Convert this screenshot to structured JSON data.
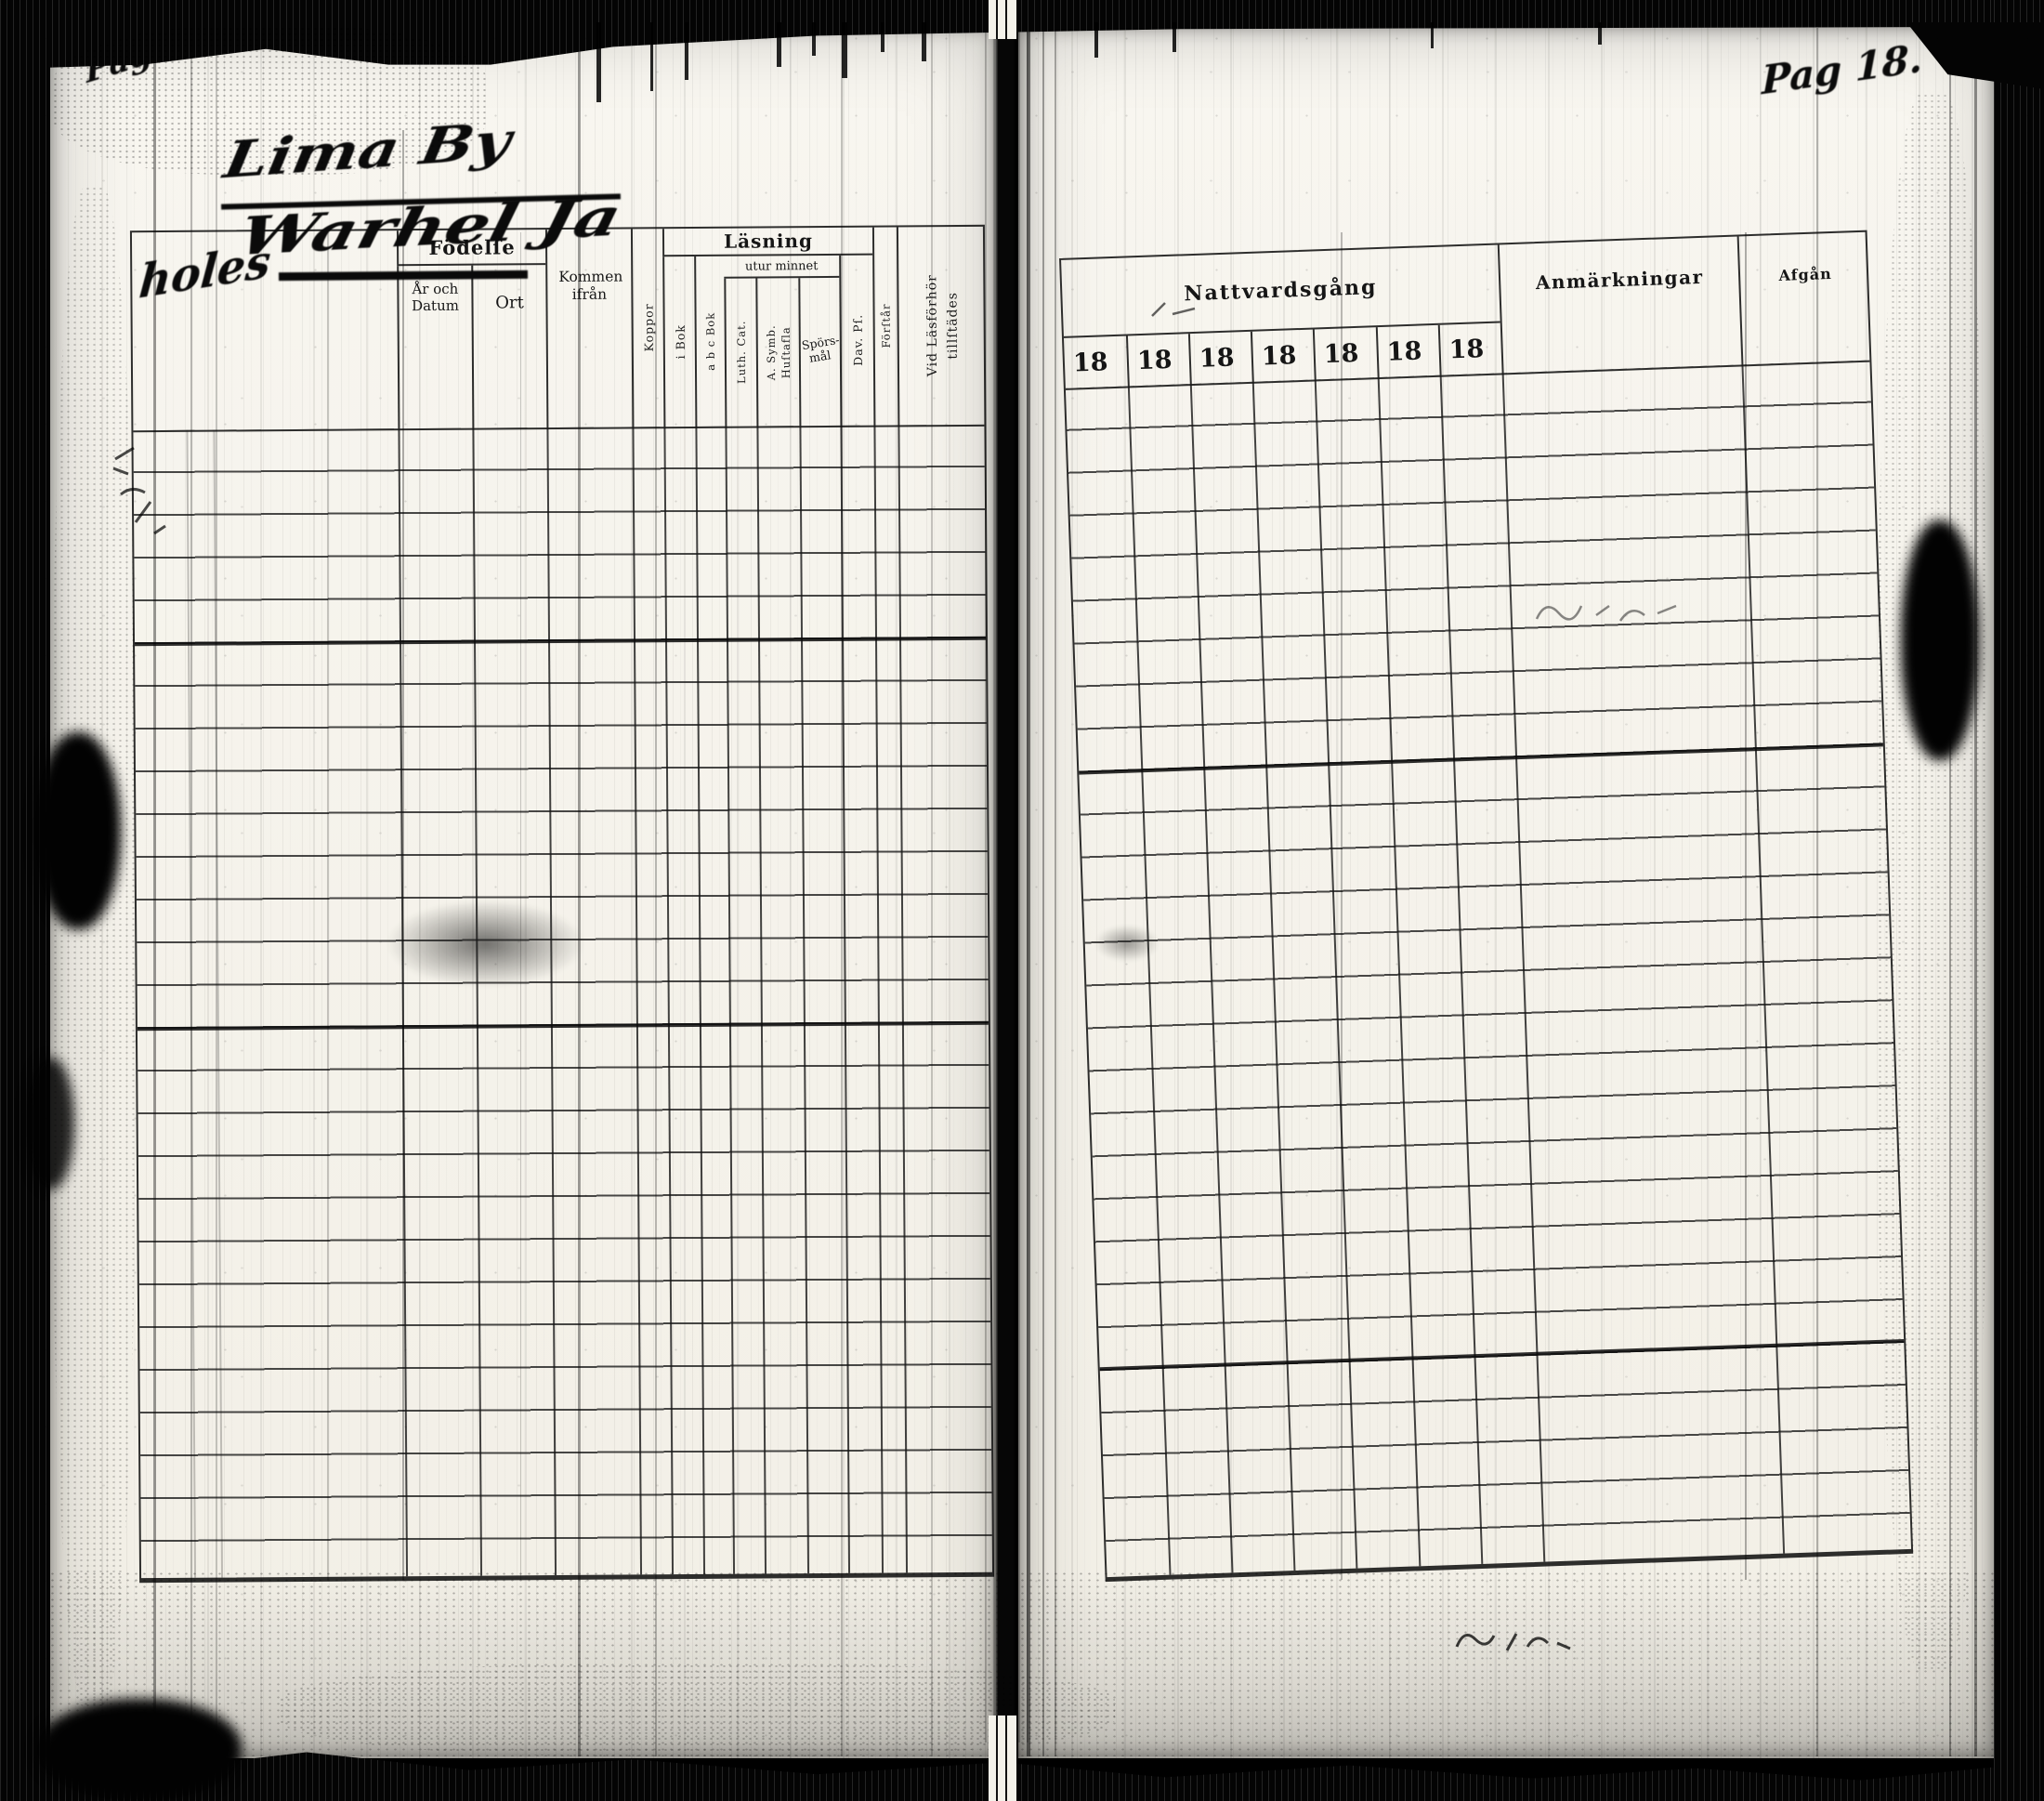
{
  "scan": {
    "left_page_number": "Pag 17.",
    "right_page_number": "Pag 18.",
    "handwritten_heading": {
      "line1": "Lima By",
      "line2": "Warhel Ja",
      "line3": "holes"
    },
    "left_table": {
      "birth_group": {
        "label": "Födelſe",
        "year_col": "År och Datum",
        "place_col": "Ort"
      },
      "arrived_from": "Kommen ifrån",
      "smallpox_col": "Koppor",
      "reading_group": {
        "label": "Läsning",
        "from_memory_label": "utur minnet",
        "in_book_col": "i Bok",
        "abc_book_col": "a b c Bok",
        "luther_catechism_col": "Luth. Cat.",
        "athanasian_line1": "A. Symb.",
        "athanasian_line2": "Huſtafla",
        "questions_line1": "Spörs-",
        "questions_line2": "mål",
        "davids_psalms_col": "Dav. Pſ.",
        "understands_col": "Förſtår"
      },
      "attendance_line1": "Vid Läsförhör",
      "attendance_line2": "tillſtädes"
    },
    "right_table": {
      "communion_label": "Nattvardsgång",
      "year_cells": [
        "18",
        "18",
        "18",
        "18",
        "18",
        "18",
        "18"
      ],
      "remarks_label": "Anmärkningar",
      "departure_label": "Afgån"
    }
  }
}
